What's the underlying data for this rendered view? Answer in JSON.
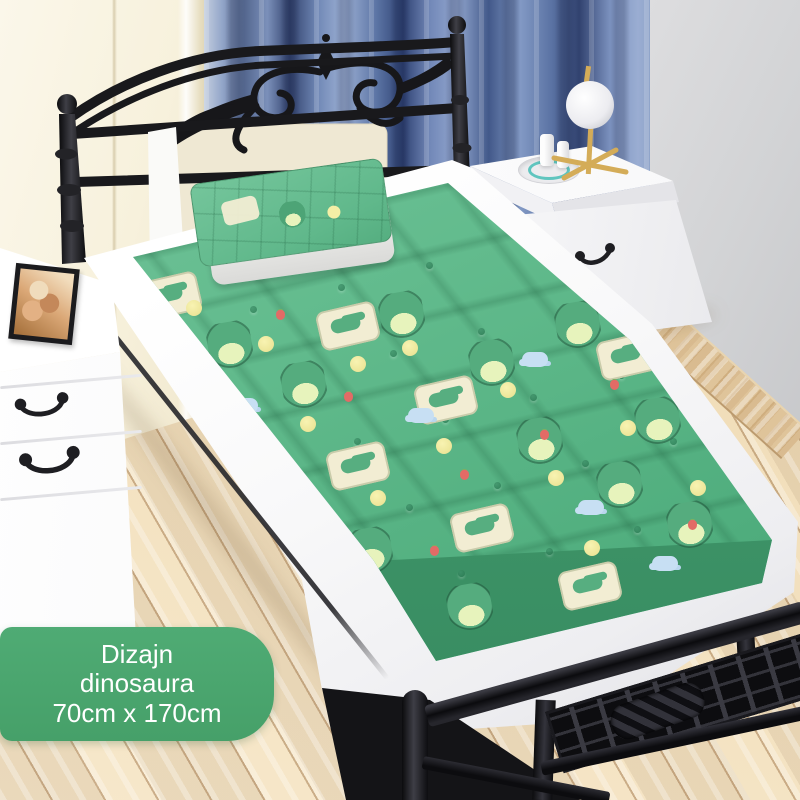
{
  "product_label": {
    "line1": "Dizajn",
    "line2": "dinosaura",
    "line3": "70cm x 170cm"
  },
  "palette": {
    "label_green": "#4AA36D",
    "label_text": "#FFFFFF",
    "mattress_green": "#5FB98A",
    "mattress_side_green": "#3E9468",
    "pattern_cream": "#F2EDD3",
    "pattern_yellow": "#F0E89C",
    "pattern_blue_cloud": "#C7DFF3",
    "curtain_blue_dark": "#2F4273",
    "curtain_blue_light": "#9DB0D4",
    "wall_cream": "#F7F1DC",
    "wall_grey": "#D2D3D5",
    "floor_wood": "#F1DEBA",
    "trim_wood": "#D9BB90",
    "iron_black": "#1B1B1E",
    "lamp_gold": "#D4AC58",
    "furniture_white": "#FBFBFC",
    "bracelet_teal": "#3CBBB3"
  }
}
